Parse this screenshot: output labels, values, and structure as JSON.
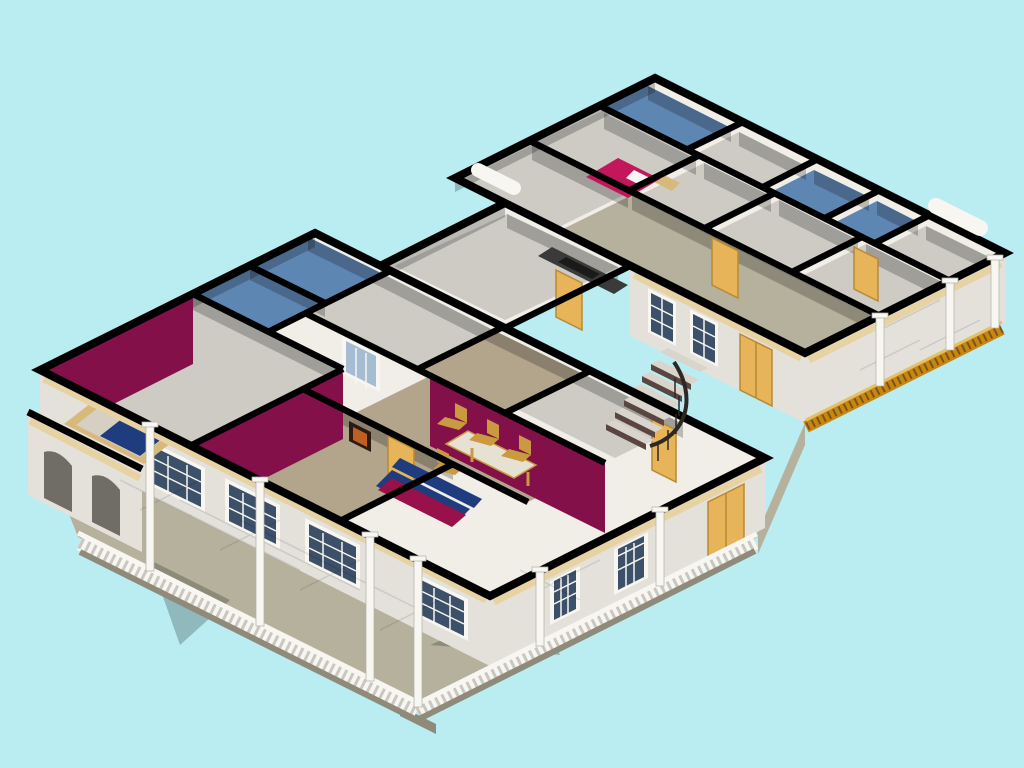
{
  "scene": {
    "kind": "isometric-house-cutaway-render",
    "description": "3D isometric dollhouse cutaway rendering of a single-story residence with blue tiled bathrooms, maroon accent walls, yellow doors, furnished living and dining rooms, a curved staircase, a white balustraded wrap-around front porch and a gold-railed side veranda",
    "background": "#b9edf2"
  },
  "palette": {
    "background": "#b9edf2",
    "band": "#000000",
    "wallLight": "#f0eee7",
    "wallMid": "#e3e1da",
    "floorGray": "#cdcbc4",
    "tileBlue": "#5e86b2",
    "tileTan": "#b3a58c",
    "stone": "#b6b19c",
    "stoneDark": "#8f8a79",
    "shadow": "#000000",
    "maroon": "#84104a",
    "magenta": "#c2185b",
    "doorYellow": "#e7b45a",
    "doorYellowDark": "#b98a33",
    "frameWhite": "#f7f6f1",
    "glass": "#3d5069",
    "glassLight": "#a4bdd2",
    "tan": "#e6d2a2",
    "goldRail": "#c8860f",
    "goldRailDark": "#7a551b",
    "goldRailLight": "#e5c06a",
    "sofaBlue": "#1e3c7e",
    "sofaMaroon": "#99114a",
    "wood": "#c99a3f",
    "tableTop": "#e7e1d3",
    "counter": "#3a3a3a",
    "counterInset": "#1a1a1a",
    "stairDark": "#5a4540",
    "treadLight": "#d9d5cc",
    "railDark": "#2e2824",
    "archDark": "#6f6d66",
    "balusterShade": "#c9c7c0",
    "columnEdge": "#b5b3ac",
    "bedFrame": "#d8b97c",
    "mattress": "#d6d0c4",
    "paintingFrame": "#2b1b12",
    "paintingArt": "#c06020"
  }
}
